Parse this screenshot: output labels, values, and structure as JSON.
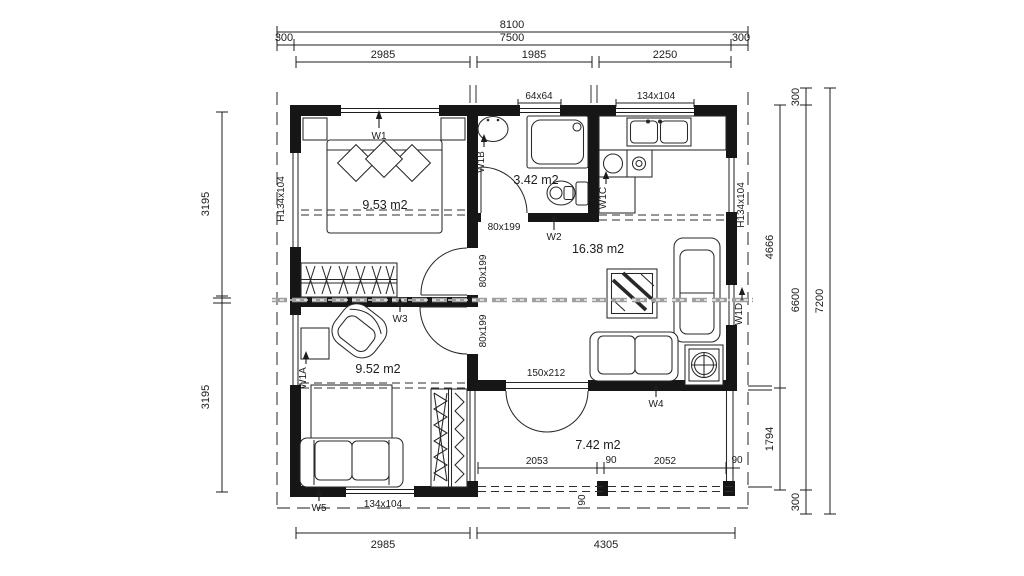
{
  "rooms": {
    "bedroom1": "9.53 m2",
    "bathroom": "3.42 m2",
    "living": "16.38 m2",
    "bedroom2": "9.52 m2",
    "terrace": "7.42 m2"
  },
  "dims": {
    "top_total": "8100",
    "top_left300": "300",
    "top_7500": "7500",
    "top_right300": "300",
    "top_2985": "2985",
    "top_1985": "1985",
    "top_2250": "2250",
    "left_3195a": "3195",
    "left_3195b": "3195",
    "right_300t": "300",
    "right_4666": "4666",
    "right_1794": "1794",
    "right_300b": "300",
    "right_6600": "6600",
    "right_7200": "7200",
    "bot_2985": "2985",
    "bot_4305": "4305",
    "ter_2053": "2053",
    "ter_90a": "90",
    "ter_2052": "2052",
    "ter_90b": "90",
    "ter_90c": "90"
  },
  "openings": {
    "w1": "W1",
    "w2": "W2",
    "w3": "W3",
    "w4": "W4",
    "w5": "W5",
    "w1a": "W1A",
    "w1b": "W1B",
    "w1c": "W1C",
    "w1d": "W1D",
    "win_64x64": "64x64",
    "win_kitchen": "134x104",
    "win_left": "H134x104",
    "win_right": "H134x104",
    "win_bottom": "134x104",
    "door_bath": "80x199",
    "door_up": "80x199",
    "door_low": "80x199",
    "door_terrace": "150x212"
  }
}
